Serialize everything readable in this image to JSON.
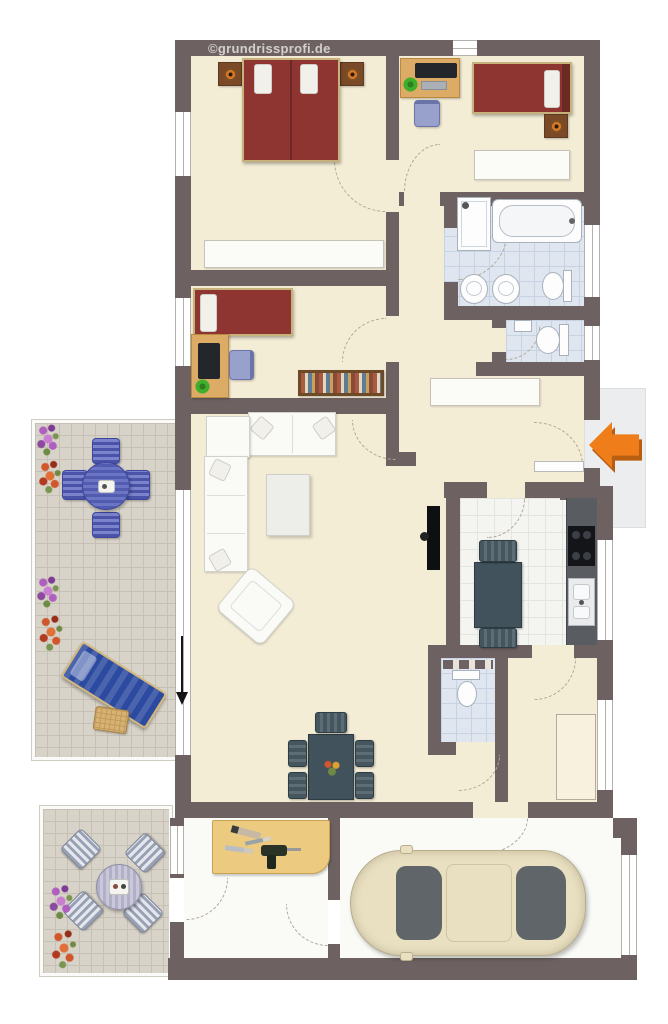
{
  "watermark": {
    "text": "©grundrissprofi.de"
  },
  "colors": {
    "wall": "#6d6161",
    "floor_cream": "#f4edd6",
    "white_floor": "#fafaf7",
    "bath_tile": "#dfe6f0",
    "bath_grout": "#c7d2e2",
    "kitchen_tile": "#f4f4f1",
    "kitchen_grout": "#e4e4e0",
    "terrace_tile": "#d8d3c8",
    "terrace_grout": "#c6c1b4",
    "bed_red": "#8e3531",
    "bed_frame": "#c8b27c",
    "wood": "#dcab66",
    "wood_dark": "#7a4a28",
    "lamp_orange": "#d5782a",
    "slate": "#41525c",
    "blue_table": "#515cb0",
    "lounger": "#2c4ba0",
    "car_body": "#e9e0c2",
    "car_glass": "#5f6569",
    "arrow_orange": "#ee7d1a",
    "arrow_shadow": "#b85e10",
    "arc": "#b3a697",
    "porch": "#ecedef",
    "workbench": "#eccb80",
    "plant": "#3fae2a",
    "monitor": "#23272b"
  },
  "legend": [
    "double-bed",
    "single-bed",
    "nightstand",
    "wardrobe",
    "desk",
    "monitor",
    "office-chair",
    "bookshelf",
    "shower",
    "bathtub",
    "washbasin",
    "bidet",
    "toilet",
    "corner-sofa",
    "coffee-table",
    "armchair",
    "tv",
    "dining-table",
    "dining-chair",
    "kitchen-counter",
    "cooktop",
    "kitchen-sink",
    "kitchen-table",
    "hall-sideboard",
    "built-in-closet",
    "workbench",
    "tools",
    "car",
    "patio-table",
    "patio-chair",
    "sun-lounger",
    "side-table",
    "flower-bed",
    "entrance-arrow",
    "north-arrow",
    "door-swing-arc",
    "window"
  ]
}
